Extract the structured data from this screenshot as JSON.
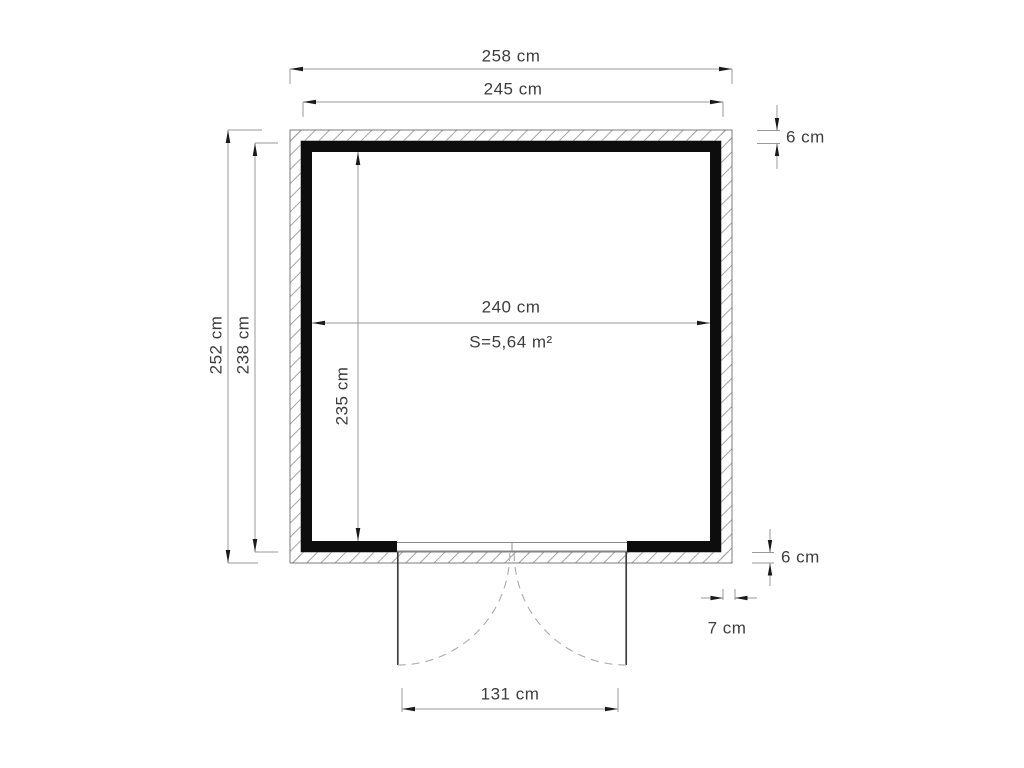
{
  "drawing": {
    "type": "floor-plan",
    "area_label": "S=5,64 m²",
    "unit": "cm",
    "door": {
      "leaves": 2,
      "swing": "outward"
    }
  },
  "dimensions": {
    "outer_width": "258 cm",
    "frame_width": "245 cm",
    "inner_width": "240 cm",
    "outer_height": "252 cm",
    "frame_height": "238 cm",
    "inner_height": "235 cm",
    "wall_thickness_top": "6 cm",
    "wall_thickness_bottom": "6 cm",
    "wall_offset": "7 cm",
    "door_width": "131 cm"
  },
  "colors": {
    "wall_frame": "#0d0d0d",
    "dimension_line": "#999999",
    "text": "#3d3d3d",
    "background": "#ffffff"
  }
}
